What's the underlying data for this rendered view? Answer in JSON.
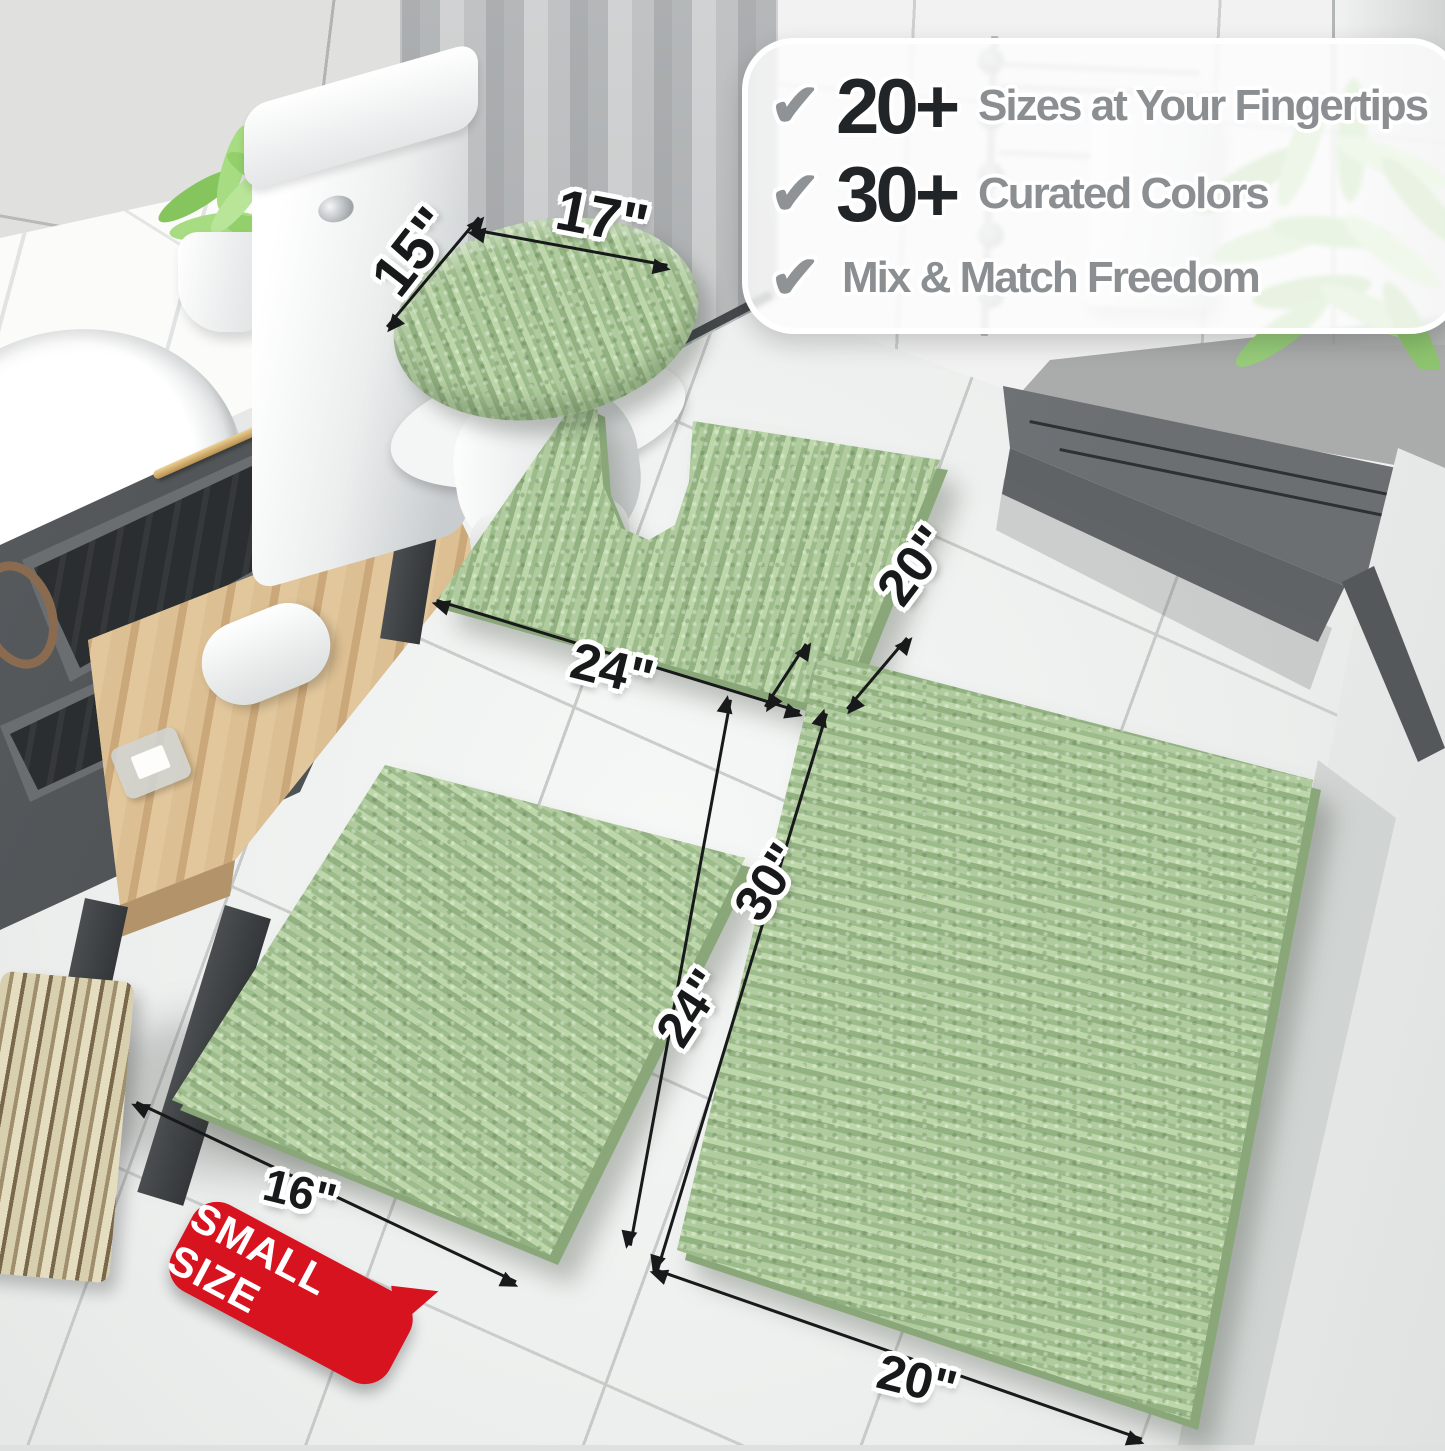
{
  "callout": {
    "check_glyph": "✔",
    "items": [
      {
        "number": "20+",
        "text": "Sizes at Your Fingertips"
      },
      {
        "number": "30+",
        "text": "Curated Colors"
      },
      {
        "number": "",
        "text": "Mix & Match Freedom"
      }
    ]
  },
  "dimensions": {
    "lid_cover_width": "17\"",
    "lid_cover_depth": "15\"",
    "contour_rug_width": "24\"",
    "contour_rug_depth": "20\"",
    "small_rug_length": "24\"",
    "small_rug_width": "16\"",
    "large_rug_length": "30\"",
    "large_rug_width": "20\""
  },
  "badge": {
    "label": "SMALL SIZE"
  },
  "colors": {
    "rug_sage": "#a9c79a",
    "badge_red": "#d6131f",
    "callout_number": "#222527",
    "callout_text": "#8b8f91",
    "dimension_text": "#17191a"
  }
}
